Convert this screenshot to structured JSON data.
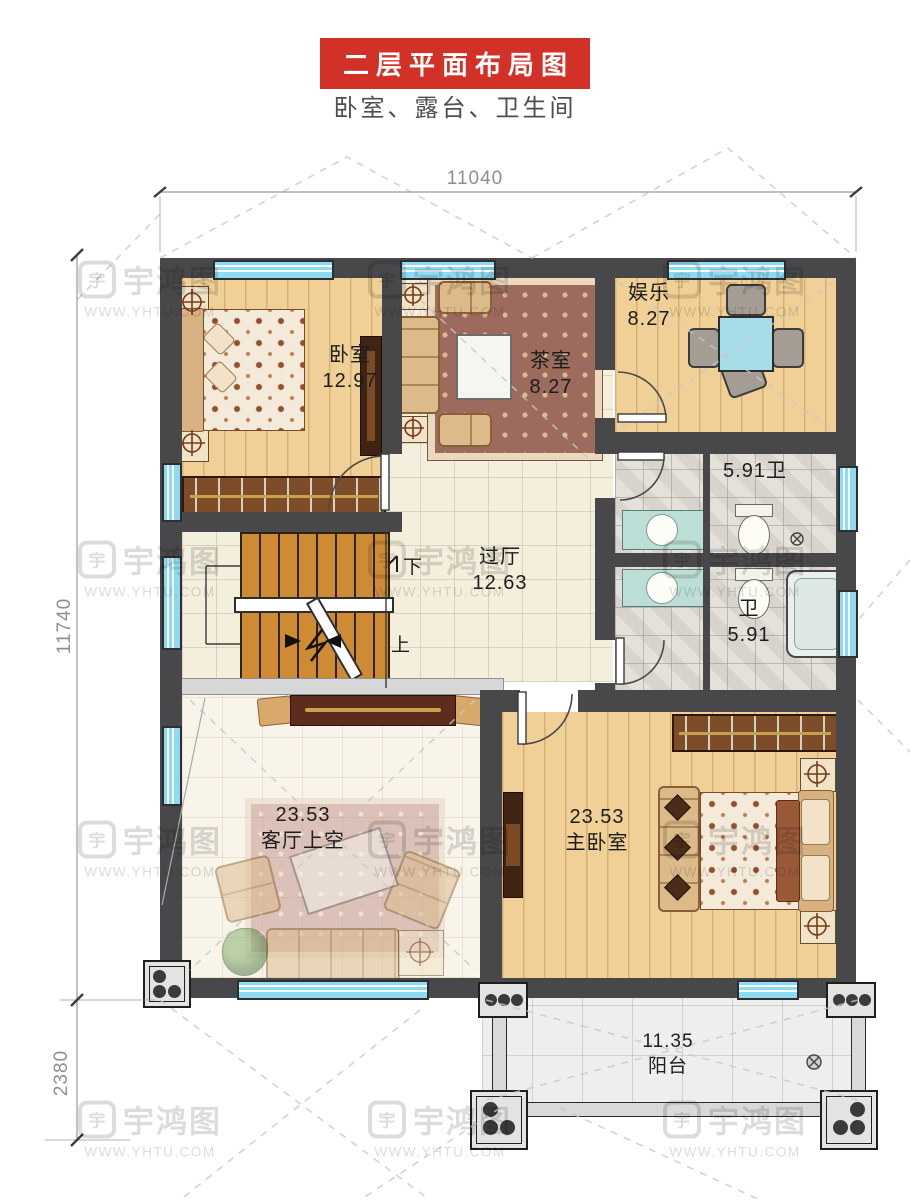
{
  "title": "二层平面布局图",
  "subtitle": "卧室、露台、卫生间",
  "dims": {
    "width_top": "11040",
    "height_main": "11740",
    "height_balcony": "2380"
  },
  "watermark": {
    "brand": "宇鸿图",
    "site": "WWW.YHTU.COM"
  },
  "rooms": [
    {
      "id": "bedroom",
      "name": "卧室",
      "area": "12.97"
    },
    {
      "id": "tea-room",
      "name": "茶室",
      "area": "8.27"
    },
    {
      "id": "entertainment",
      "name": "娱乐",
      "area": "8.27"
    },
    {
      "id": "bath-1",
      "name": "卫",
      "area": "5.91"
    },
    {
      "id": "hall",
      "name": "过厅",
      "area": "12.63"
    },
    {
      "id": "bath-2",
      "name": "卫",
      "area": "5.91"
    },
    {
      "id": "living-void",
      "name": "客厅上空",
      "area": "23.53"
    },
    {
      "id": "master",
      "name": "主卧室",
      "area": "23.53"
    },
    {
      "id": "balcony",
      "name": "阳台",
      "area": "11.35"
    }
  ],
  "stairs": {
    "down_label": "下",
    "up_label": "上"
  },
  "colors": {
    "accent_red": "#d23128",
    "wall": "#48484a",
    "window": "#8edaf2",
    "wood_floor": "#f0d096",
    "stair_tread": "#cf8a34"
  }
}
